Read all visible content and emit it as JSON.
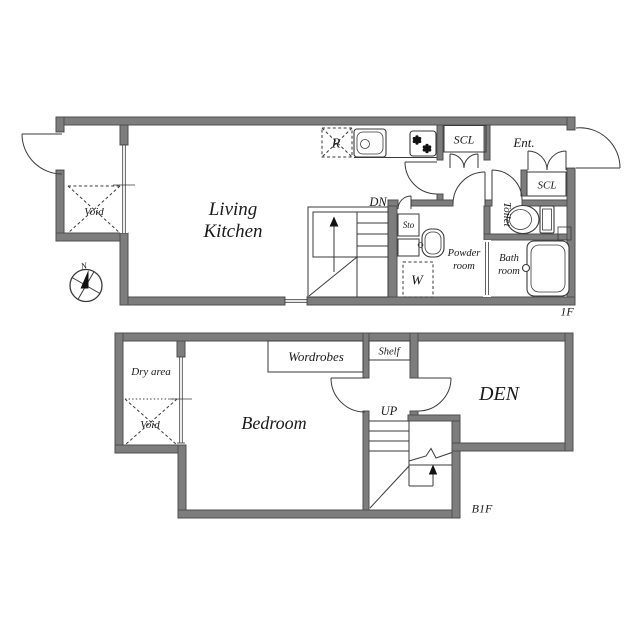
{
  "document_type": "floor-plan",
  "colors": {
    "wall": "#7d7d7d",
    "wall_edge": "#4f4f4f",
    "line": "#3a3a3a",
    "text": "#1a1a1a",
    "background": "#ffffff"
  },
  "compass": {
    "north": "N"
  },
  "floor_1f": {
    "floor_label": "1F",
    "living_kitchen_line1": "Living",
    "living_kitchen_line2": "Kitchen",
    "entrance": "Ent.",
    "closet_hall": "SCL",
    "closet_entrance": "SCL",
    "toilet": "Toilet",
    "powder_line1": "Powder",
    "powder_line2": "room",
    "bath_line1": "Bath",
    "bath_line2": "room",
    "void": "Void",
    "storage": "Sto",
    "stairs_down": "DN",
    "refrigerator": "R",
    "washing_machine": "W"
  },
  "floor_b1f": {
    "floor_label": "B1F",
    "bedroom": "Bedroom",
    "den": "DEN",
    "dry_area": "Dry area",
    "void": "Void",
    "wardrobe": "Wordrobes",
    "shelf": "Shelf",
    "stairs_up": "UP"
  }
}
